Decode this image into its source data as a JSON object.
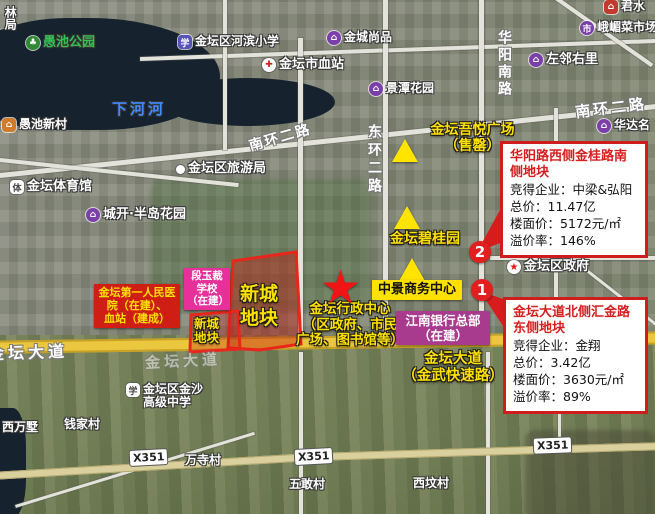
{
  "pois": {
    "partial_top_left": {
      "label": "林局"
    },
    "yuchi_park": {
      "label": "愚池公园",
      "glyph": "♣"
    },
    "yuchi_new_village": {
      "label": "愚池新村",
      "glyph": "⌂"
    },
    "xiahe_river": {
      "label": "下河河"
    },
    "hebin_primary_school": {
      "label": "金坛区河滨小学",
      "glyph": "学"
    },
    "jintan_blood_station": {
      "label": "金坛市血站",
      "glyph": "✚"
    },
    "jincheng_shangpin": {
      "label": "金城尚品",
      "glyph": "⌂"
    },
    "jingtan_garden": {
      "label": "景潭花园",
      "glyph": "⌂"
    },
    "zuolin_youli": {
      "label": "左邻右里",
      "glyph": "⌂"
    },
    "emei_market": {
      "label": "峨嵋菜市场",
      "glyph": "市"
    },
    "top_right_partial": {
      "label": "君水",
      "glyph": "⌂"
    },
    "huada_partial": {
      "label": "华达名",
      "glyph": "⌂"
    },
    "jintan_stadium": {
      "label": "金坛体育馆",
      "glyph": "体"
    },
    "chengkai_peninsula_garden": {
      "label": "城开·半岛花园",
      "glyph": "⌂"
    },
    "jintan_tourism_bureau": {
      "label": "金坛区旅游局"
    },
    "jintan_district_government": {
      "label": "金坛区政府",
      "glyph": "★"
    },
    "jinsha_high_school": {
      "lines": [
        "金坛区金沙",
        "高级中学"
      ],
      "glyph": "学"
    },
    "qianjia_village": {
      "label": "钱家村"
    },
    "xiwanshu": {
      "label": "西万墅"
    },
    "wansi_village": {
      "label": "万寺村"
    },
    "wugan_village": {
      "label": "五敢村"
    },
    "xiwen_village": {
      "label": "西坟村"
    }
  },
  "roads": {
    "huayang_south_road": "华阳南路",
    "nanhuan_2nd_road_ne": "南环二路",
    "nanhuan_2nd_road_w": "南环二路",
    "donghuan_2nd_road": "东环二路",
    "jintan_avenue_left": "金坛大道",
    "jintan_avenue_faint": "金坛大道",
    "x351": "X351"
  },
  "annotations": {
    "wuyue_plaza": {
      "lines": [
        "金坛吾悦广场",
        "（售罄）"
      ]
    },
    "biguiyuan": {
      "label": "金坛碧桂园"
    },
    "zhongjing_business_center": {
      "label": "中景商务中心"
    },
    "admin_center": {
      "lines": [
        "金坛行政中心",
        "（区政府、市民",
        "广场、图书馆等）"
      ]
    },
    "jintan_avenue_expressway": {
      "lines": [
        "金坛大道",
        "（金武快速路）"
      ]
    },
    "xincheng_plot_large": {
      "lines": [
        "新城",
        "地块"
      ]
    },
    "xincheng_plot_small": {
      "lines": [
        "新城",
        "地块"
      ]
    },
    "duanyucai_school": {
      "lines": [
        "段玉裁",
        "学校",
        "（在建）"
      ]
    },
    "hospital_box": {
      "lines": [
        "金坛第一人民医",
        "院（在建）、",
        "血站（建成）"
      ]
    },
    "jiangnan_bank": {
      "lines": [
        "江南银行总部",
        "（在建）"
      ]
    }
  },
  "info_boxes": {
    "box1": {
      "title": "华阳路西侧金桂路南侧地块",
      "rows": [
        "竞得企业：中梁&弘阳",
        "总价：11.47亿",
        "楼面价：5172元/㎡",
        "溢价率：146%"
      ]
    },
    "box2": {
      "title": "金坛大道北侧汇金路东侧地块",
      "rows": [
        "竞得企业：金翔",
        "总价：3.42亿",
        "楼面价：3630元/㎡",
        "溢价率：89%"
      ]
    }
  },
  "markers": {
    "circle1": "1",
    "circle2": "2"
  },
  "colors": {
    "plot_red": "#e8261b",
    "annotation_yellow": "#ffe100",
    "info_border_red": "#cf1d1d",
    "bank_purple": "#a93b8f",
    "school_pink": "#e8309a",
    "hospital_red": "#cf1f14",
    "avenue_yellow": "#eac73e"
  }
}
